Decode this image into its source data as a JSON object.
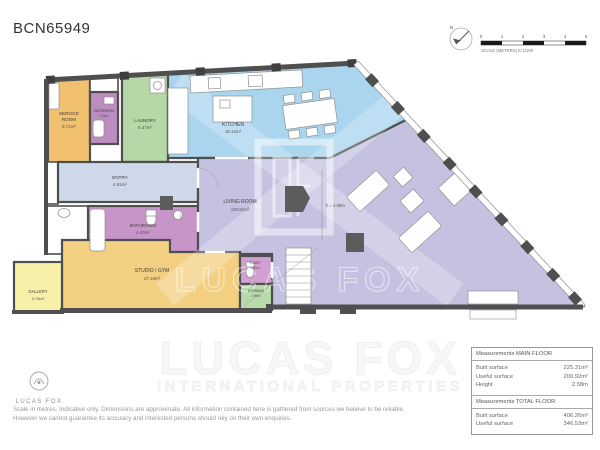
{
  "page": {
    "title": "BCN65949"
  },
  "compass": {
    "label": "N"
  },
  "scale_bar": {
    "ticks": [
      "0",
      "1",
      "2",
      "3",
      "4",
      "5"
    ],
    "caption": "SCALE (METERS) E:1/100"
  },
  "rooms": [
    {
      "name": "SERVICE",
      "name2": "ROOM",
      "area": "8.71m²",
      "color": "#f1c170"
    },
    {
      "name": "BATHROOM",
      "area": "2.53m²",
      "color": "#bd8cc0"
    },
    {
      "name": "LAUNDRY",
      "area": "8.47m²",
      "color": "#b5d8a6"
    },
    {
      "name": "KITCHEN",
      "area": "36.12m²",
      "color": "#a9d5ef"
    },
    {
      "name": "ENTRY",
      "area": "4.61m²",
      "color": "#cdd9ea"
    },
    {
      "name": "BATHROOM",
      "area": "4.43m²",
      "color": "#c795c8"
    },
    {
      "name": "LIVING ROOM",
      "area": "100.81m²",
      "color": "#c5c2e1"
    },
    {
      "name": "STUDIO / GYM",
      "area": "27.18m²",
      "color": "#f3cf82"
    },
    {
      "name": "TOILET",
      "area": "1.32m²",
      "color": "#cfa0d0"
    },
    {
      "name": "STORAGE",
      "area": "2.99m²",
      "color": "#b7dbaa"
    },
    {
      "name": "GALLERY",
      "area": "3.78m²",
      "color": "#f6f0a8"
    }
  ],
  "annotations": {
    "ceiling_height": "h = 4.80m"
  },
  "watermark": {
    "name": "LUCAS FOX",
    "tagline": "INTERNATIONAL PROPERTIES"
  },
  "footer": {
    "logo_text": "LUCAS FOX",
    "disclaimer_line1": "Scale in metres. Indicative only. Dimensions are approximate. All information contained here is gathered from sources we believe to be reliable.",
    "disclaimer_line2": "However we cannot guarantee its accuracy and interested persons should rely on their own enquiries."
  },
  "measurements": {
    "main": {
      "header": "Measurements MAIN FLOOR",
      "rows": [
        {
          "label": "Built surface",
          "value": "225.31m²"
        },
        {
          "label": "Useful surface",
          "value": "200.92m²"
        },
        {
          "label": "Height",
          "value": "2.58m"
        }
      ]
    },
    "total": {
      "header": "Measurements TOTAL FLOOR",
      "rows": [
        {
          "label": "Built surface",
          "value": "406.26m²"
        },
        {
          "label": "Useful surface",
          "value": "346.53m²"
        }
      ]
    }
  }
}
